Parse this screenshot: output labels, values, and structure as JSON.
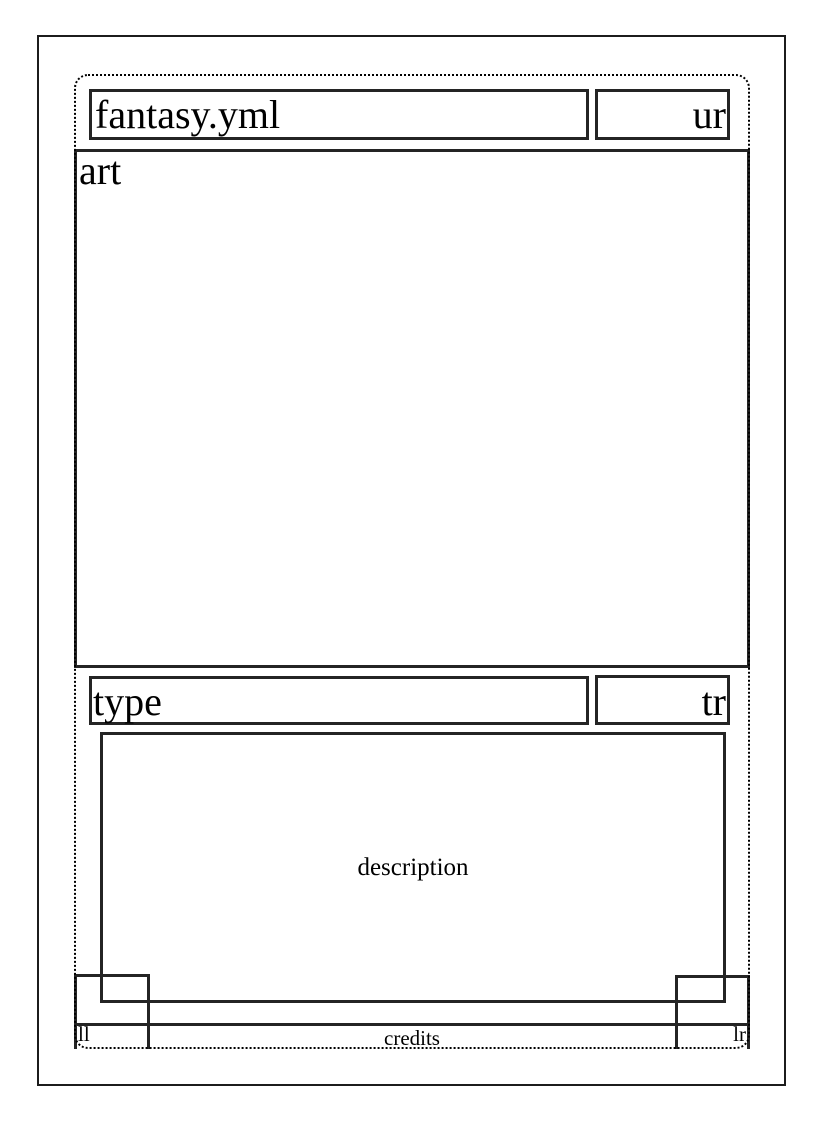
{
  "card_template": {
    "zones": {
      "title": "fantasy.yml",
      "upper_right": "ur",
      "art": "art",
      "type": "type",
      "type_right": "tr",
      "description": "description",
      "lower_left": "ll",
      "lower_right": "lr",
      "credits": "credits"
    },
    "colors": {
      "line": "#242424",
      "frame_line": "#1c1c1c",
      "dotted_guide": "#000000",
      "text": "#000000",
      "background": "#ffffff"
    }
  }
}
